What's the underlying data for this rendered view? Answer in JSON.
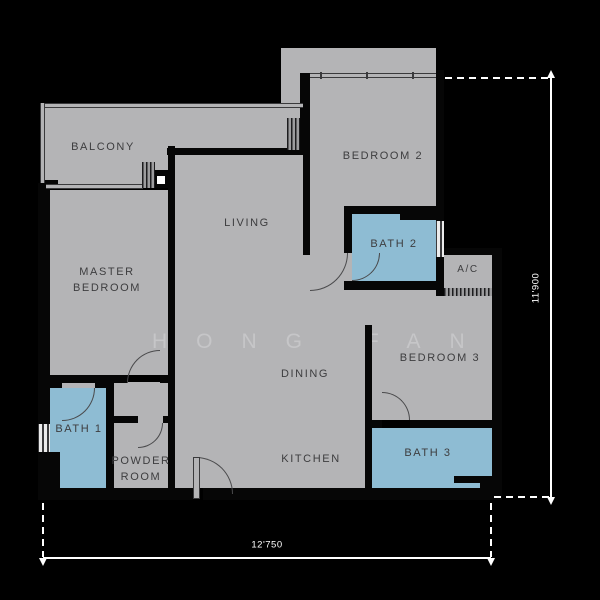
{
  "canvas": {
    "width": 600,
    "height": 600,
    "background": "#000000"
  },
  "floorplan": {
    "watermark": "HONG FAN",
    "rooms": {
      "balcony": "BALCONY",
      "master_bedroom": [
        "MASTER",
        "BEDROOM"
      ],
      "living": "LIVING",
      "bedroom2": "BEDROOM 2",
      "bath2": "BATH 2",
      "ac": "A/C",
      "bedroom3": "BEDROOM 3",
      "dining": "DINING",
      "kitchen": "KITCHEN",
      "bath3": "BATH 3",
      "bath1": "BATH 1",
      "powder_room": [
        "POWDER",
        "ROOM"
      ]
    },
    "dimensions": {
      "right": "11'900",
      "bottom": "12'750"
    },
    "colors": {
      "floor": "#b4b4b6",
      "bath": "#8ebcd3",
      "wall": "#000000",
      "label": "#3d3d3f",
      "dimension_lines": "#ffffff",
      "watermark": "#c6c6c8"
    }
  }
}
